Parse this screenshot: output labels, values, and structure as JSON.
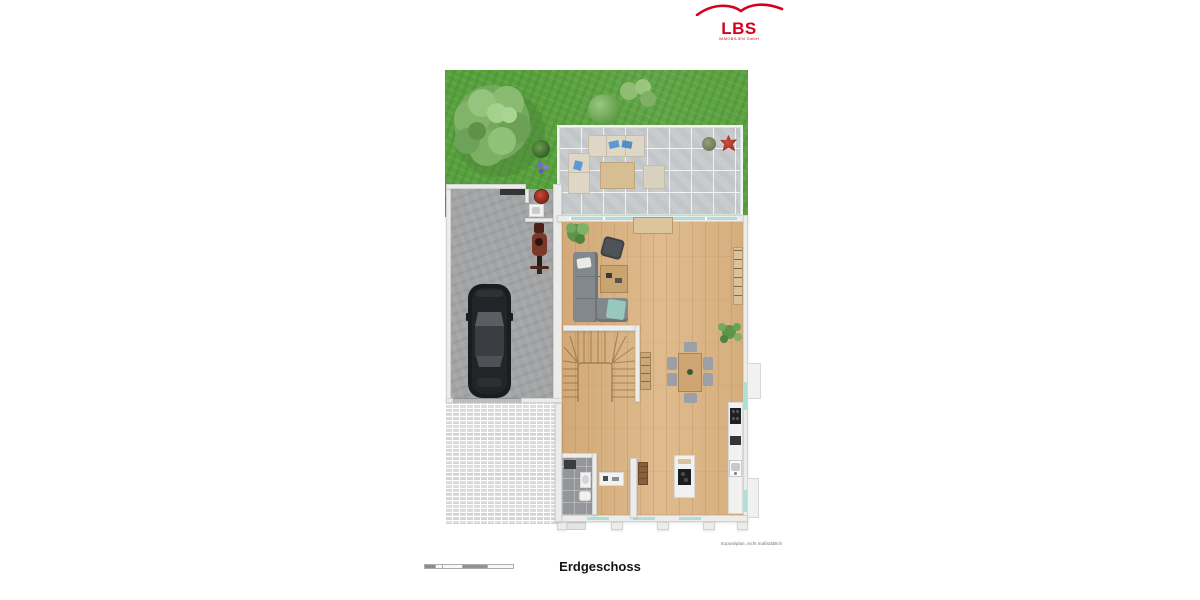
{
  "logo": {
    "text": "LBS",
    "subtitle": "IMMOBILIEN GmbH",
    "color": "#d5001e"
  },
  "plan": {
    "title": "Erdgeschoss",
    "disclaimer": "Exposéplan, nicht maßstäblich",
    "colors": {
      "lawn_green": "#58a23d",
      "terrace_tile": "#c8ccce",
      "wood_floor": "#d7b184",
      "garage_concrete": "#a2a4a5",
      "paving": "#dededc",
      "wall_white": "#ecedeb",
      "window_glass": "#aeded9",
      "car_black": "#1b1c1e",
      "sofa_gray": "#83888d",
      "boiler_red": "#b03a2e",
      "accent_plant_red": "#b93629"
    }
  }
}
